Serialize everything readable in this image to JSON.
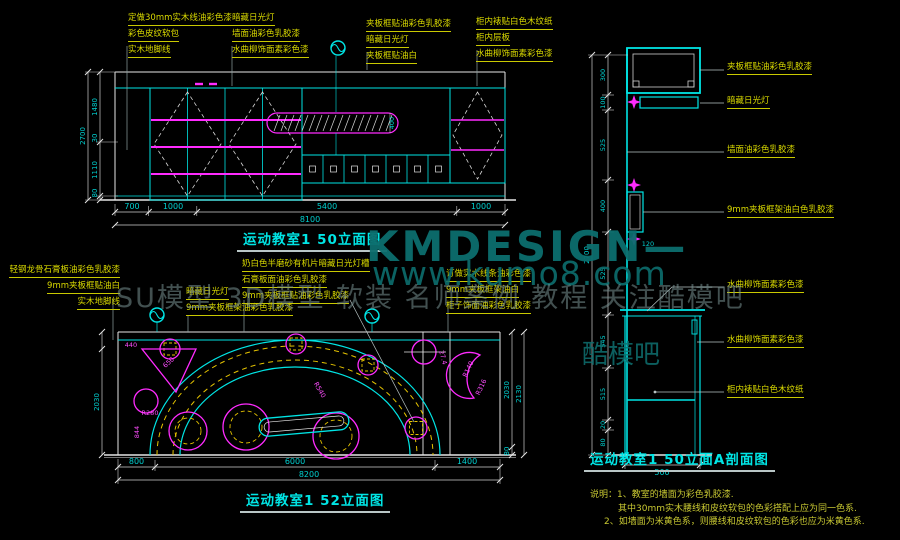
{
  "watermark": {
    "brand": "KMDESIGN—",
    "url": "www.kumo8.com",
    "tagline": "SU模型 3D模型 软装 名师案例 教程 关注酷模吧",
    "fragment": "酷模吧"
  },
  "colors": {
    "background": "#000000",
    "line_cyan": "#00e5e5",
    "line_white": "#e6e6e6",
    "magenta": "#ff2bff",
    "dash_yellow": "#e6c400",
    "label_yellow": "#d9d900",
    "dim_cyan": "#00cfcf",
    "watermark_teal": "#0c6e6e"
  },
  "top_elevation": {
    "title": "运动教室1 50立面图",
    "labels_left": [
      "定做30mm实木线油彩色漆",
      "彩色皮纹软包",
      "实木地脚线"
    ],
    "labels_mid": [
      "暗藏日光灯",
      "墙面油彩色乳胶漆",
      "水曲柳饰面素彩色漆"
    ],
    "labels_right1": [
      "夹板框贴油彩色乳胶漆",
      "暗藏日光灯",
      "夹板框贴油白"
    ],
    "labels_right2": [
      "柜内裱贴白色木纹纸",
      "柜内层板",
      "水曲柳饰面素彩色漆"
    ],
    "dims_bottom": [
      "700",
      "1000",
      "5400",
      "1000"
    ],
    "dim_total": "8100",
    "dims_left": [
      "1480",
      "30",
      "1110",
      "80"
    ],
    "dim_left_total": "2700",
    "dim_strip": "400"
  },
  "bottom_elevation": {
    "title": "运动教室1 52立面图",
    "labels_left": [
      "轻钢龙骨石膏板油彩色乳胶漆",
      "9mm夹板框贴油白",
      "实木地脚线"
    ],
    "labels_mid": [
      "暗藏日光灯",
      "9mm夹板框架油彩色乳胶漆"
    ],
    "labels_top": [
      "奶白色半磨砂有机片暗藏日光灯槽",
      "石膏板面油彩色乳胶漆",
      "9mm夹板框贴油彩色乳胶漆"
    ],
    "labels_right": [
      "订做实木线条油彩色漆",
      "9mm夹板框架油白",
      "柜子饰面油彩色乳胶漆"
    ],
    "dims_bottom": [
      "800",
      "6000",
      "1400"
    ],
    "dim_total": "8200",
    "dim_left": "2030",
    "dims_right": [
      "2030",
      "80"
    ],
    "dim_right_total": "2130",
    "annotations": {
      "a440": "440",
      "a650": "650",
      "r280": "R280",
      "a844": "844",
      "r540": "R540",
      "r316": "R316",
      "r140": "R140",
      "a274": "27.4"
    }
  },
  "section": {
    "title": "运动教室1 50立面A剖面图",
    "labels": [
      "夹板框贴油彩色乳胶漆",
      "暗藏日光灯",
      "墙面油彩色乳胶漆",
      "9mm夹板框架油白色乳胶漆",
      "水曲柳饰面素彩色漆",
      "水曲柳饰面素彩色漆",
      "柜内裱贴白色木纹纸"
    ],
    "dims": [
      "300",
      "100",
      "525",
      "400",
      "525",
      "545",
      "515",
      "20",
      "80"
    ],
    "dim_total": "2700",
    "dim_bottom": "500",
    "dim_small": "120"
  },
  "notes": {
    "lines": [
      "说明：1、教室的墙面为彩色乳胶漆.",
      "其中30mm实木腰线和皮纹软包的色彩搭配上应为同一色系.",
      "2、如墙面为米黄色系，则腰线和皮纹软包的色彩也应为米黄色系."
    ]
  }
}
